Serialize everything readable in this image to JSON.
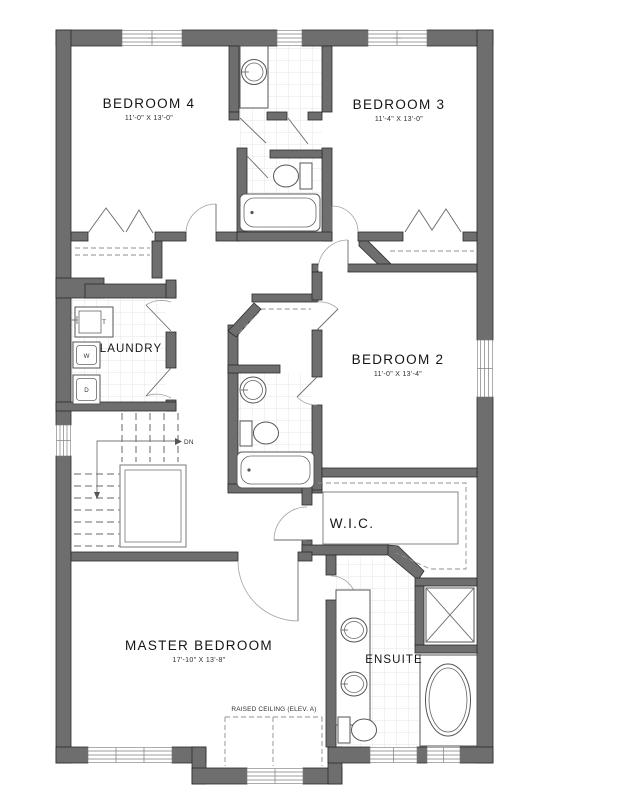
{
  "colors": {
    "wall": "#6e6e6e",
    "wall_outline": "#2b2b2b",
    "fixture_line": "#555555",
    "tile_line": "#dcdcdc",
    "text": "#151515",
    "background": "#ffffff"
  },
  "rooms": {
    "bedroom4": {
      "label": "BEDROOM 4",
      "dims": "11'-0\" X 13'-0\""
    },
    "bedroom3": {
      "label": "BEDROOM 3",
      "dims": "11'-4\" X 13'-0\""
    },
    "bedroom2": {
      "label": "BEDROOM 2",
      "dims": "11'-0\" X 13'-4\""
    },
    "master": {
      "label": "MASTER BEDROOM",
      "dims": "17'-10\" X 13'-8\""
    },
    "laundry": {
      "label": "LAUNDRY"
    },
    "wic": {
      "label": "W.I.C."
    },
    "ensuite": {
      "label": "ENSUITE"
    }
  },
  "annotations": {
    "raised_ceiling": "RAISED CEILING (ELEV. A)",
    "stairs_down": "DN",
    "laundry_tub": "T",
    "washer": "W",
    "dryer": "D"
  }
}
